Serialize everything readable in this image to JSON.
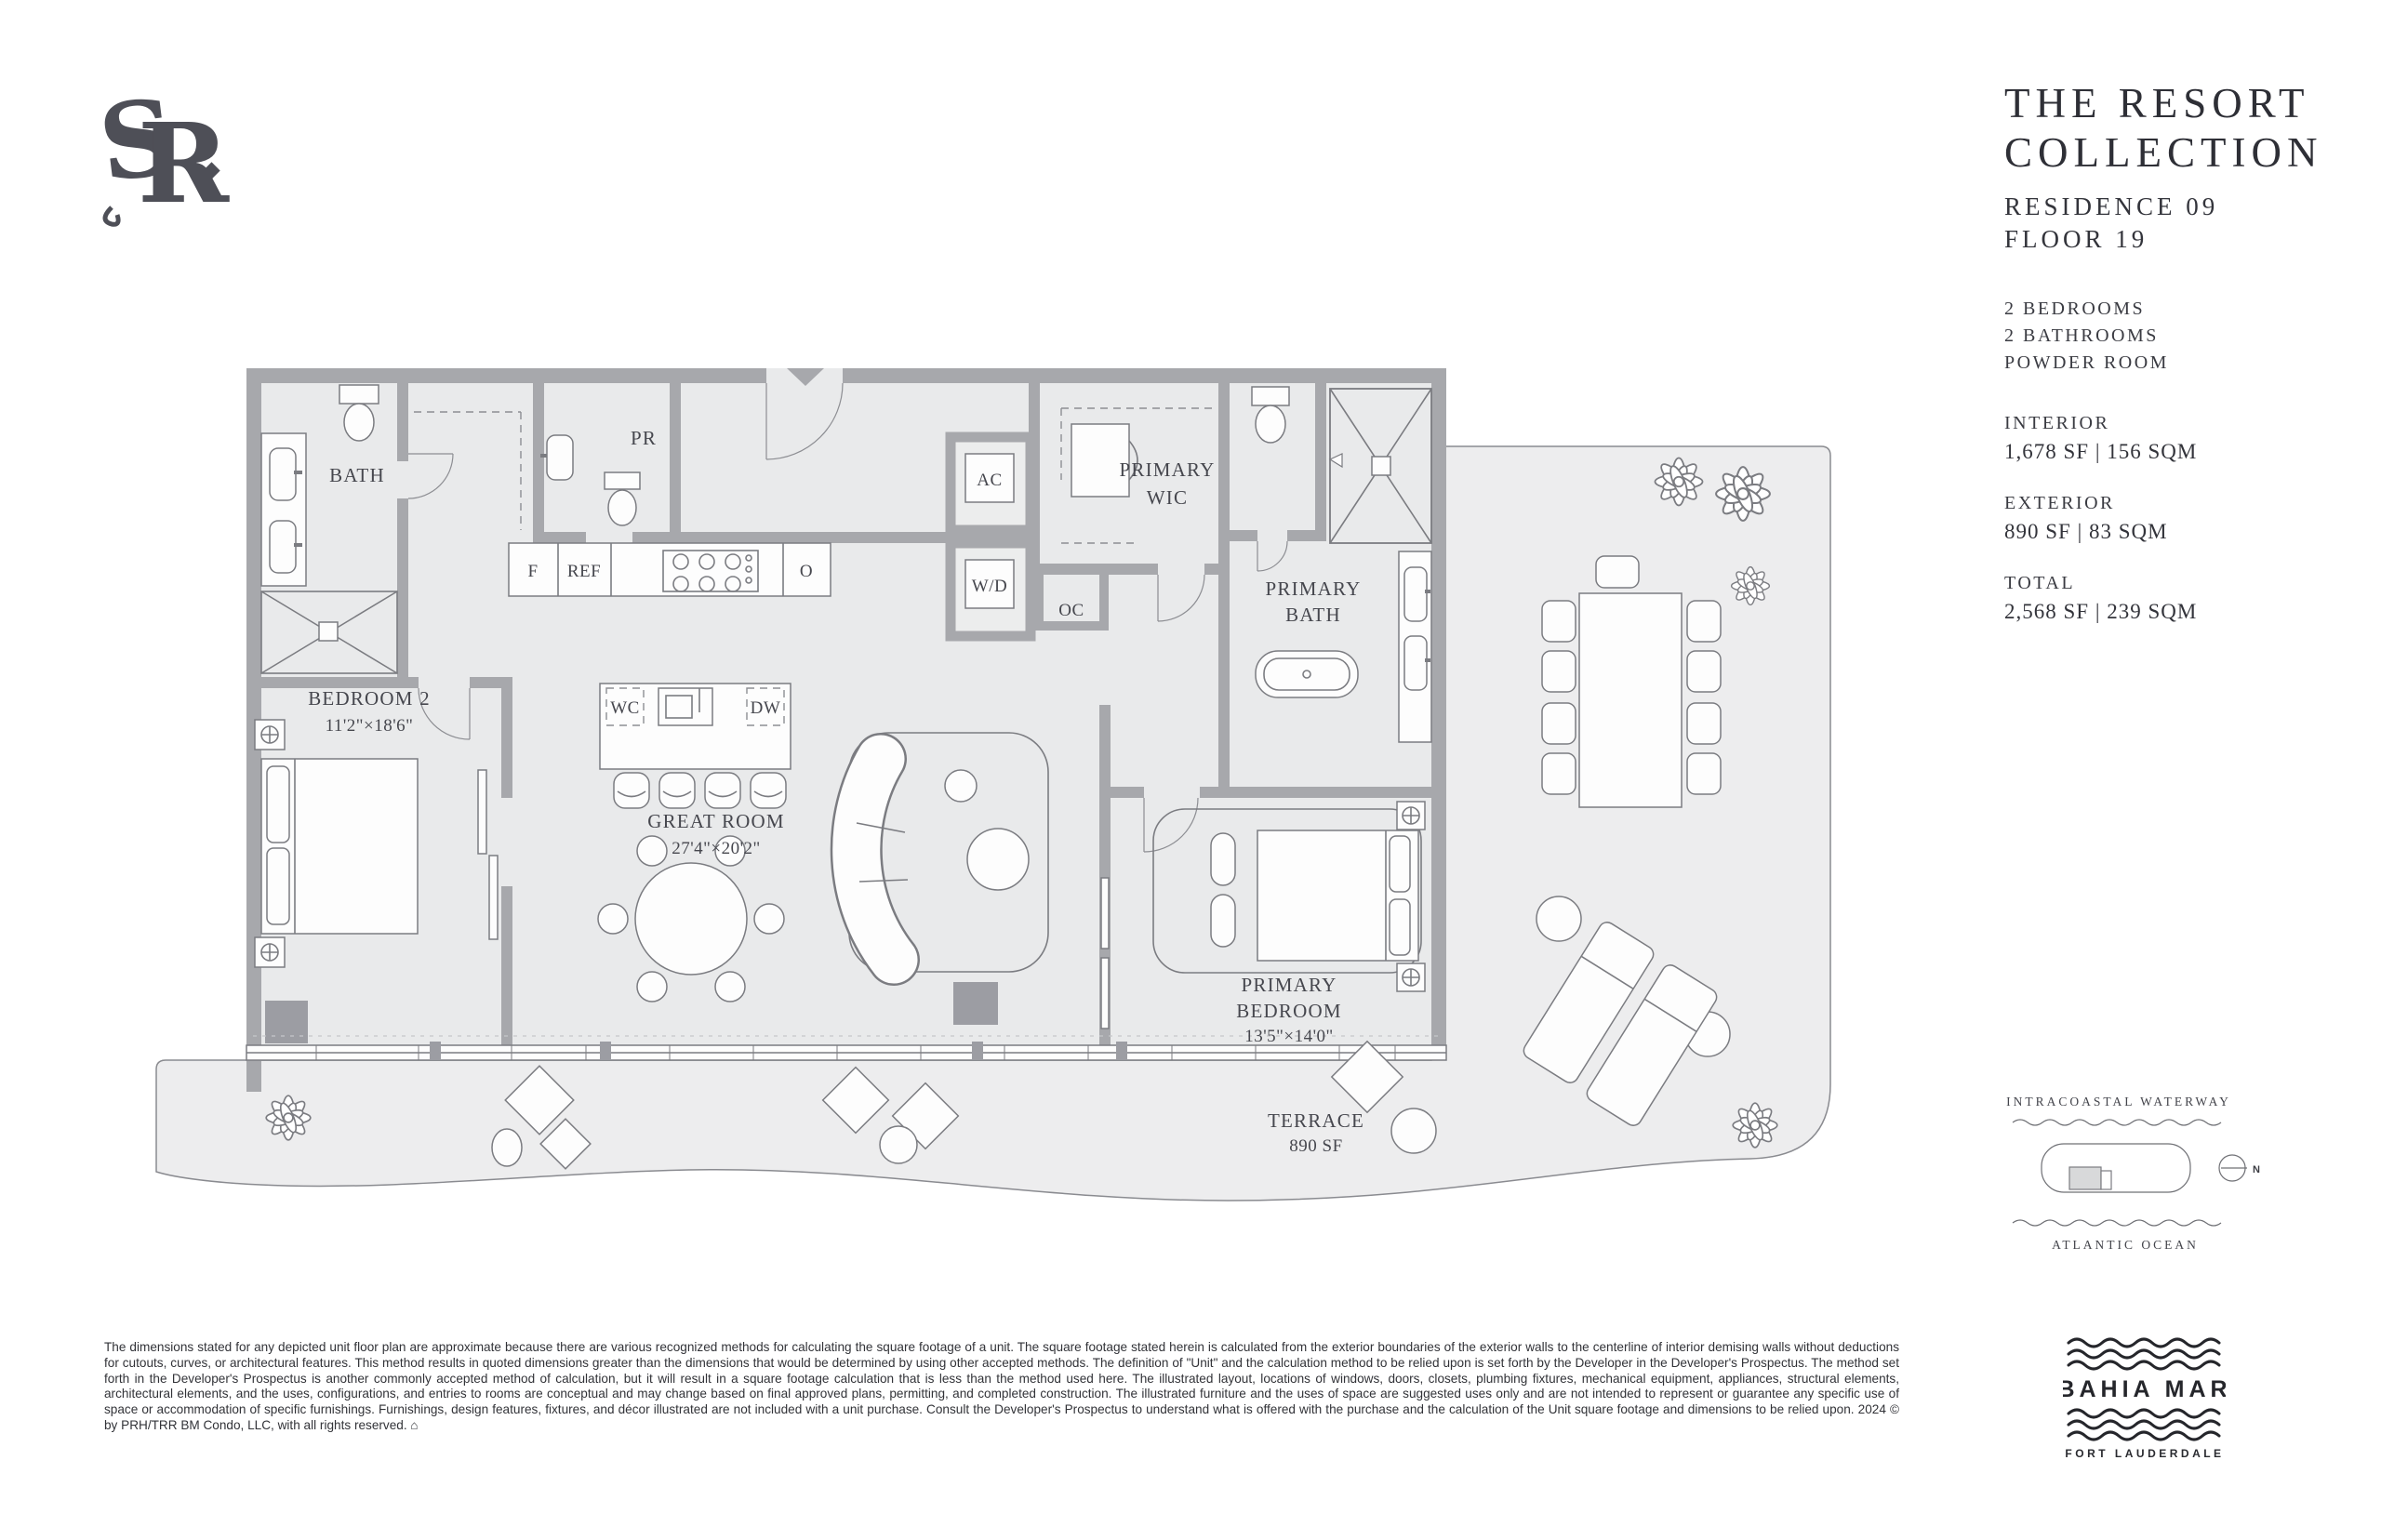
{
  "header": {
    "title_line1": "THE RESORT",
    "title_line2": "COLLECTION",
    "residence": "RESIDENCE 09",
    "floor": "FLOOR 19",
    "features": [
      "2 BEDROOMS",
      "2 BATHROOMS",
      "POWDER ROOM"
    ],
    "areas": [
      {
        "label": "INTERIOR",
        "value": "1,678 SF | 156 SQM"
      },
      {
        "label": "EXTERIOR",
        "value": "890 SF | 83 SQM"
      },
      {
        "label": "TOTAL",
        "value": "2,568 SF | 239 SQM"
      }
    ]
  },
  "plan": {
    "labels": {
      "bath": "BATH",
      "pr": "PR",
      "ac": "AC",
      "wd": "W/D",
      "oc": "OC",
      "wic1": "PRIMARY",
      "wic2": "WIC",
      "pbath1": "PRIMARY",
      "pbath2": "BATH",
      "f": "F",
      "ref": "REF",
      "o": "O",
      "wc": "WC",
      "dw": "DW",
      "bedroom2": "BEDROOM 2",
      "bedroom2_dims": "11'2\"×18'6\"",
      "great": "GREAT ROOM",
      "great_dims": "27'4\"×20'2\"",
      "pbed1": "PRIMARY",
      "pbed2": "BEDROOM",
      "pbed_dims": "13'5\"×14'0\"",
      "terrace": "TERRACE",
      "terrace_sf": "890 SF"
    }
  },
  "site": {
    "waterway": "INTRACOASTAL WATERWAY",
    "ocean": "ATLANTIC OCEAN",
    "compass": "N"
  },
  "brand": {
    "mono_s": "S",
    "mono_r": "R",
    "name": "BAHIA MAR",
    "city": "FORT LAUDERDALE"
  },
  "colors": {
    "wall": "#a7a8ac",
    "floor": "#e9eaeb",
    "terrace_floor": "#ededee",
    "line": "#7b7c81",
    "text": "#3a3b42"
  },
  "disclaimer": "The dimensions stated for any depicted unit floor plan are approximate because there are various recognized methods for calculating the square footage of a unit. The square footage stated herein is calculated from the exterior boundaries of the exterior walls to the centerline of interior demising walls without deductions for cutouts, curves, or architectural features. This method results in quoted dimensions greater than the dimensions that would be determined by using other accepted methods. The definition of \"Unit\" and the calculation method to be relied upon is set forth by the Developer in the Developer's Prospectus. The method set forth in the Developer's Prospectus is another commonly accepted method of calculation, but it will result in a square footage calculation that is less than the method used here. The illustrated layout, locations of windows, doors, closets, plumbing fixtures, mechanical equipment, appliances, structural elements, architectural elements, and the uses, configurations, and entries to rooms are conceptual and may change based on final approved plans, permitting, and completed construction. The illustrated furniture and the uses of space are suggested uses only and are not intended to represent or guarantee any specific use of space or accommodation of specific furnishings. Furnishings, design features, fixtures, and décor illustrated are not included with a unit purchase. Consult the Developer's Prospectus to understand what is offered with the purchase and the calculation of the Unit square footage and dimensions to be relied upon. 2024 © by PRH/TRR BM Condo, LLC, with all rights reserved. ⌂"
}
